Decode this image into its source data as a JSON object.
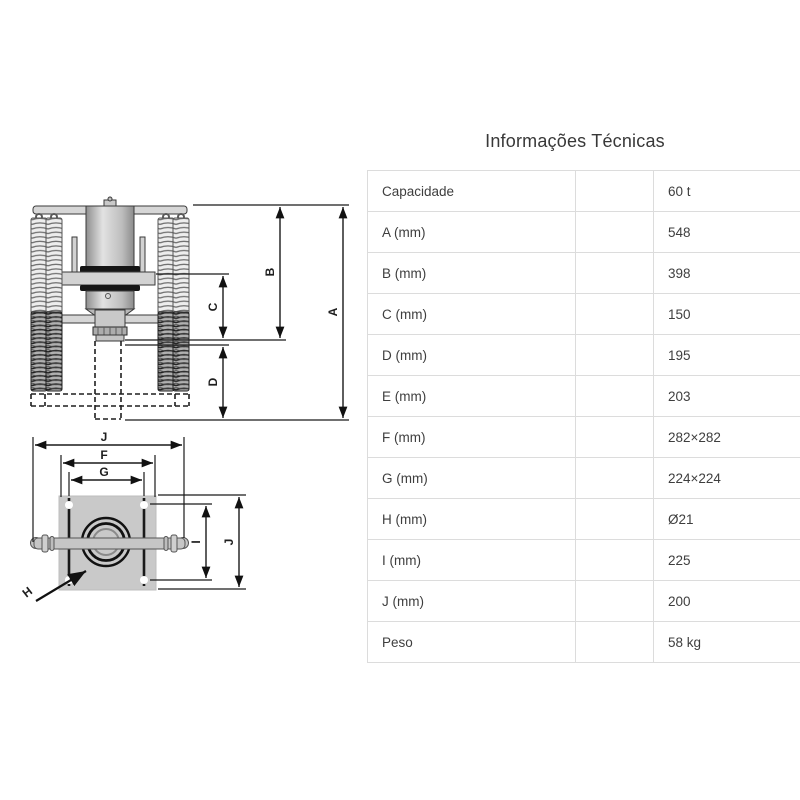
{
  "title": "Informações Técnicas",
  "table": {
    "rows": [
      {
        "label": "Capacidade",
        "value": "60 t"
      },
      {
        "label": "A (mm)",
        "value": "548"
      },
      {
        "label": "B (mm)",
        "value": "398"
      },
      {
        "label": "C (mm)",
        "value": "150"
      },
      {
        "label": "D (mm)",
        "value": "195"
      },
      {
        "label": "E (mm)",
        "value": "203"
      },
      {
        "label": "F (mm)",
        "value": "282×282"
      },
      {
        "label": "G (mm)",
        "value": "224×224"
      },
      {
        "label": "H (mm)",
        "value": "Ø21"
      },
      {
        "label": "I (mm)",
        "value": "225"
      },
      {
        "label": "J (mm)",
        "value": "200"
      },
      {
        "label": "Peso",
        "value": "58 kg"
      }
    ]
  },
  "drawing": {
    "side_view_labels": {
      "A": "A",
      "B": "B",
      "C": "C",
      "D": "D"
    },
    "plan_view_labels": {
      "J_top": "J",
      "F": "F",
      "G": "G",
      "I": "I",
      "J_right": "J",
      "H": "H"
    }
  },
  "colors": {
    "table_border": "#dcdcdc",
    "body_text": "#3e3e3e",
    "drawing_line": "#1a1a1a",
    "plate_gray": "#c9c9c9"
  }
}
